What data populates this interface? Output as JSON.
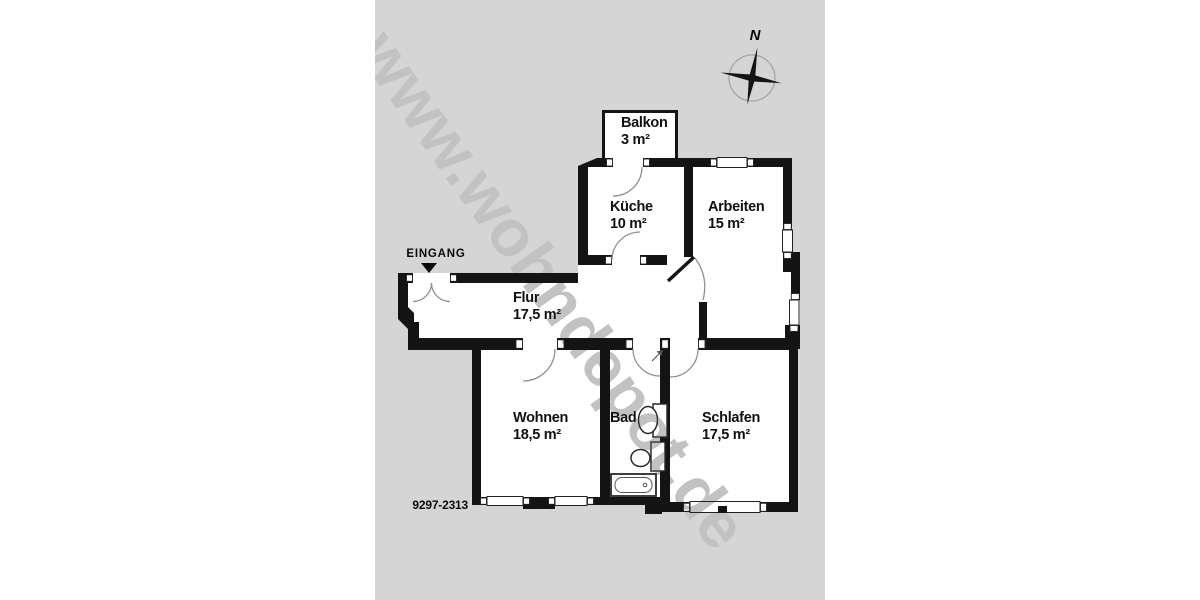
{
  "watermark_text": "www.wohndepot.de",
  "compass_north_label": "N",
  "entrance_label": "EINGANG",
  "plan_number": "9297-2313",
  "rooms": {
    "balkon": {
      "name": "Balkon",
      "area": "3 m²"
    },
    "kueche": {
      "name": "Küche",
      "area": "10 m²"
    },
    "arbeiten": {
      "name": "Arbeiten",
      "area": "15 m²"
    },
    "flur": {
      "name": "Flur",
      "area": "17,5 m²"
    },
    "wohnen": {
      "name": "Wohnen",
      "area": "18,5 m²"
    },
    "bad": {
      "name": "Bad"
    },
    "schlafen": {
      "name": "Schlafen",
      "area": "17,5 m²"
    }
  },
  "colors": {
    "background_gray": "#d5d5d5",
    "room_fill": "#ffffff",
    "wall": "#141414",
    "watermark": "#c2c2c2",
    "door_arc": "#909090"
  }
}
